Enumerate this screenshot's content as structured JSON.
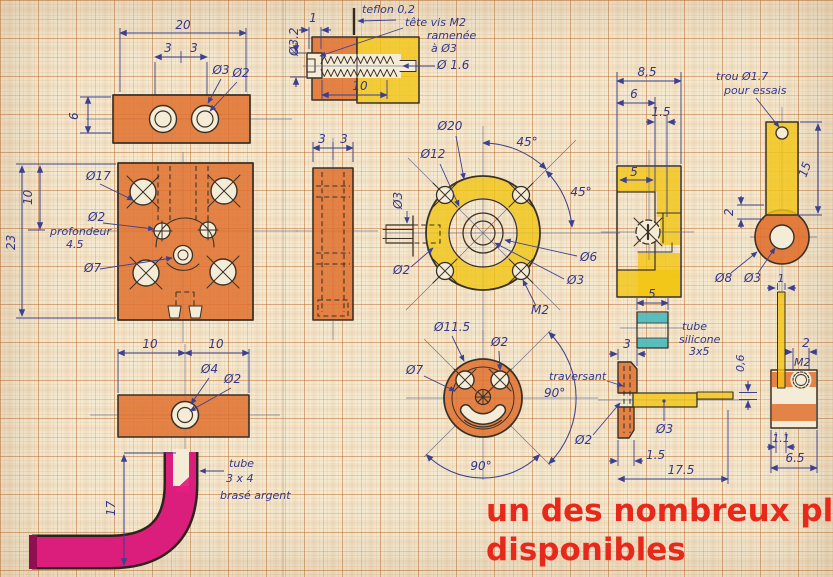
{
  "colors": {
    "paper": "#f4e9d1",
    "ink_blue": "#34378a",
    "outline": "#3a3126",
    "orange_marker": "#e1712f",
    "yellow_marker": "#f2c613",
    "magenta_marker": "#e71d82",
    "teal_marker": "#49b9bd",
    "caption_red": "#e7291b"
  },
  "caption": {
    "line1": "un des nombreux plans",
    "line2": "disponibles"
  },
  "views": {
    "top_bar": {
      "length": "20",
      "pitch1": "3",
      "pitch2": "3",
      "hole_outer": "Ø3",
      "hole_inner": "Ø2",
      "height": "6"
    },
    "screw_section": {
      "step": "1",
      "head_dia": "Ø3.2",
      "teflon_note": "teflon 0,2",
      "screw_note1": "tête vis M2",
      "screw_note2": "ramenée",
      "screw_note3": "à Ø3",
      "core_dia": "Ø 1.6",
      "thread_len": "10"
    },
    "plate": {
      "offset": "10",
      "height": "23",
      "cbore": "Ø17",
      "pin_hole": "Ø2",
      "pin_note1": "profondeur",
      "pin_note2": "4.5",
      "center_hole": "Ø7"
    },
    "side_view": {
      "pitch1": "3",
      "pitch2": "3"
    },
    "flange": {
      "outer_dia": "Ø20",
      "bolt_circle": "Ø12",
      "angle1": "45°",
      "angle2": "45°",
      "bore": "Ø6",
      "hub_bore": "Ø3",
      "screw": "M2",
      "pin_hole": "Ø2",
      "shaft_dia": "Ø3"
    },
    "bracket": {
      "width": "8,5",
      "step1": "6",
      "notch": "1.5",
      "slot": "5"
    },
    "test_strip": {
      "note1": "trou Ø1.7",
      "note2": "pour essais",
      "length": "15",
      "overlap": "2",
      "ring_outer": "Ø8",
      "ring_bore": "Ø3",
      "strip_w": "1"
    },
    "silicone_tube": {
      "width": "5",
      "note1": "tube",
      "note2": "silicone",
      "note3": "3x5"
    },
    "assembly": {
      "width": "3",
      "note": "traversant",
      "angle": "90°",
      "hole": "Ø2",
      "rod": "Ø3",
      "hub": "1.5",
      "length": "17.5",
      "flat": "0,6"
    },
    "end_block": {
      "thread_w": "2",
      "thread": "M2",
      "strip_w": "1.1",
      "width": "6.5"
    },
    "disc": {
      "outer_dia": "Ø11.5",
      "eye": "Ø2",
      "slot": "Ø7",
      "angle": "90°"
    },
    "bottom_bar": {
      "left": "10",
      "right": "10",
      "hole_outer": "Ø4",
      "hole_inner": "Ø2"
    },
    "bent_tube": {
      "height": "17",
      "note1": "tube",
      "note2": "3 x 4",
      "note3": "brasé argent"
    }
  }
}
